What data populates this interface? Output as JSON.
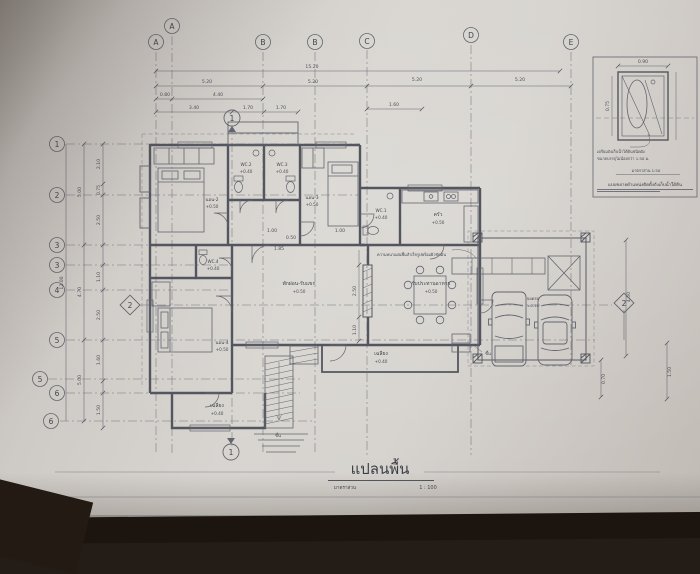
{
  "photo": {
    "paper_color": "#d3cfca",
    "ink_color": "#54565f",
    "table_color": "#1c140e"
  },
  "sheet": {
    "title": "แปลนพื้น",
    "scale_label": "มาตราส่วน",
    "scale_value": "1 : 100",
    "title_block_label": "TITLE"
  },
  "grid": {
    "top": [
      "A",
      "A",
      "B",
      "B",
      "C",
      "D",
      "E"
    ],
    "left": [
      "1",
      "2",
      "3",
      "3",
      "4",
      "5",
      "5",
      "6",
      "6"
    ],
    "sections": {
      "s1_top": "1",
      "s1_bottom": "1",
      "s2_left": "2",
      "s2_right": "2"
    }
  },
  "dims": {
    "top_total": "15.20",
    "row2": [
      "5.20",
      "5.20",
      "5.20",
      "5.20"
    ],
    "row3": [
      "0.80",
      "4.40"
    ],
    "row4": [
      "3.40",
      "1.70",
      "1.70"
    ],
    "row5": "1.60",
    "left_total": "12.00",
    "left_outer": [
      "5.00",
      "4.70",
      "5.00"
    ],
    "left_inner": [
      "2.10",
      "0.75",
      "2.50",
      "1.10",
      "2.50",
      "1.60",
      "1.50"
    ],
    "inner": [
      "1.00",
      "0.50",
      "1.85",
      "1.00",
      "2.50",
      "1.10"
    ],
    "right": [
      "4.50",
      "0.70",
      "1.50"
    ],
    "detail_top": "0.90",
    "detail_side": "0.75"
  },
  "rooms": [
    {
      "name": "WC.2",
      "level": "+0.40"
    },
    {
      "name": "WC.3",
      "level": "+0.40"
    },
    {
      "name": "นอน-2",
      "level": "+0.50"
    },
    {
      "name": "นอน-3",
      "level": "+0.50"
    },
    {
      "name": "WC.1",
      "level": "+0.40"
    },
    {
      "name": "ครัว",
      "level": "+0.50"
    },
    {
      "name": "WC.4",
      "level": "+0.40"
    },
    {
      "name": "พักผ่อน-รับแขก",
      "level": "+0.50"
    },
    {
      "name": "รับประทานอาหาร",
      "level": "+0.50"
    },
    {
      "name": "นอน-4",
      "level": "+0.50"
    },
    {
      "name": "เฉลียง",
      "level": "+0.40"
    },
    {
      "name": "เฉลียง",
      "level": "+0.40"
    },
    {
      "name": "จอดรถ",
      "level": "±0.10"
    }
  ],
  "annotations": {
    "up1": "ขึ้น",
    "up2": "ขึ้น",
    "slab_note": "ความหนาแผ่นพื้นสำเร็จรูปพร้อมผิวขัดมัน"
  },
  "detail_box": {
    "note_line1": "เตรียมถังเก็บน้ำใต้ดินชนิดฝัง",
    "note_line2": "ขนาดบรรจุไม่น้อยกว่า 1.50 ม.",
    "sub_caption": "มาตราส่วน 1:50",
    "caption": "แบบขยายตำแหน่งติดตั้งถังเก็บน้ำใต้ดิน"
  }
}
